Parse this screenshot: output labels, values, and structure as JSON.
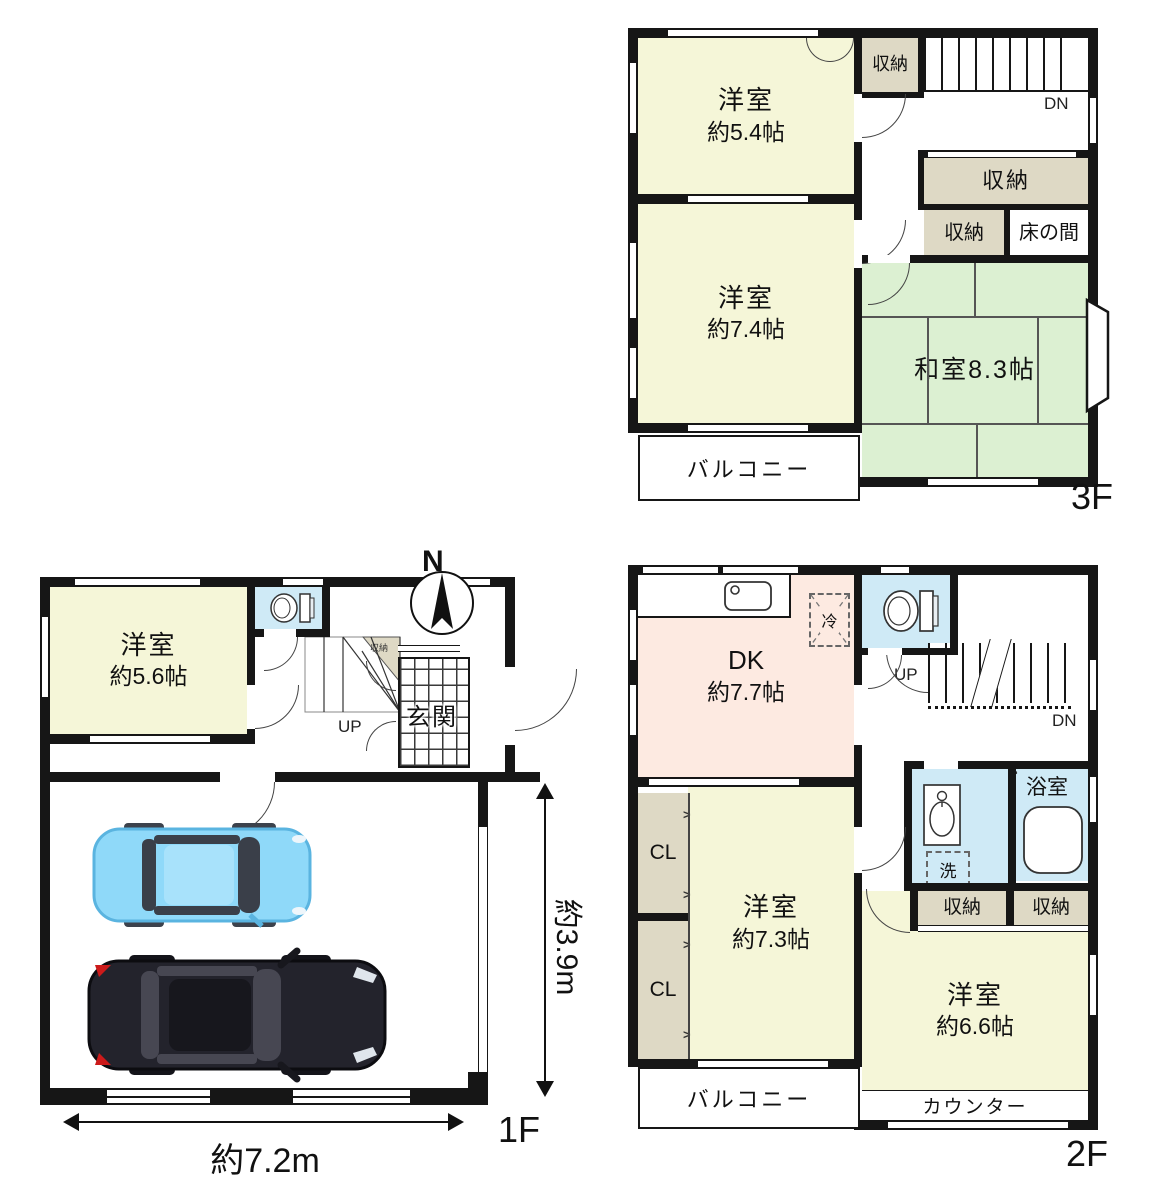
{
  "colors": {
    "wall": "#161616",
    "room_yellow": "#f5f6d8",
    "tatami_green": "#dcf0d2",
    "dk_pink": "#fdeae1",
    "water_blue": "#cfeaf6",
    "closet_beige": "#ded9c5",
    "car_blue": "#8fd9f9",
    "car_black": "#23232c"
  },
  "f3": {
    "label": "3F",
    "r1_name": "洋室",
    "r1_size": "約5.4帖",
    "r2_name": "洋室",
    "r2_size": "約7.4帖",
    "washitsu": "和室8.3帖",
    "storage_a": "収納",
    "storage_b": "収納",
    "storage_c": "収納",
    "tokonoma": "床の間",
    "balcony": "バルコニー",
    "dn": "DN"
  },
  "f2": {
    "label": "2F",
    "dk_name": "DK",
    "dk_size": "約7.7帖",
    "fridge": "冷",
    "up": "UP",
    "dn": "DN",
    "bath": "浴室",
    "laundry": "洗",
    "storage_a": "収納",
    "storage_b": "収納",
    "cl_a": "CL",
    "cl_b": "CL",
    "r1_name": "洋室",
    "r1_size": "約7.3帖",
    "r2_name": "洋室",
    "r2_size": "約6.6帖",
    "balcony": "バルコニー",
    "counter": "カウンター"
  },
  "f1": {
    "label": "1F",
    "r1_name": "洋室",
    "r1_size": "約5.6帖",
    "storage": "収納",
    "up": "UP",
    "genkan": "玄関",
    "north": "N",
    "dim_width": "約7.2m",
    "dim_height": "約3.9m"
  }
}
